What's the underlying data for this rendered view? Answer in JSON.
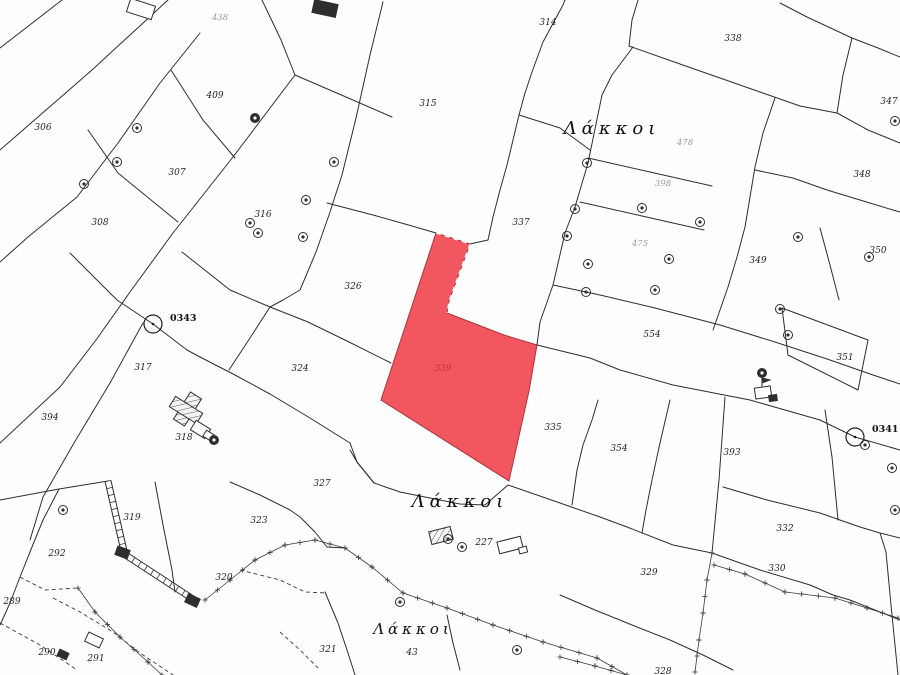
{
  "map": {
    "region_name": "Λάκκοι",
    "place_labels": [
      {
        "text": "Λάκκοι",
        "x": 612,
        "y": 134,
        "size": 18,
        "spacing": 5
      },
      {
        "text": "Λάκκοι",
        "x": 460,
        "y": 507,
        "size": 18,
        "spacing": 5
      },
      {
        "text": "Λάκκοι",
        "x": 413,
        "y": 634,
        "size": 15,
        "spacing": 4
      }
    ],
    "parcel_labels": [
      {
        "text": "306",
        "x": 43,
        "y": 130
      },
      {
        "text": "409",
        "x": 215,
        "y": 98
      },
      {
        "text": "307",
        "x": 177,
        "y": 175
      },
      {
        "text": "308",
        "x": 100,
        "y": 225
      },
      {
        "text": "316",
        "x": 263,
        "y": 217
      },
      {
        "text": "315",
        "x": 428,
        "y": 106
      },
      {
        "text": "314",
        "x": 548,
        "y": 25
      },
      {
        "text": "338",
        "x": 733,
        "y": 41
      },
      {
        "text": "347",
        "x": 889,
        "y": 104
      },
      {
        "text": "348",
        "x": 862,
        "y": 177
      },
      {
        "text": "349",
        "x": 758,
        "y": 263
      },
      {
        "text": "350",
        "x": 878,
        "y": 253
      },
      {
        "text": "351",
        "x": 845,
        "y": 360
      },
      {
        "text": "337",
        "x": 521,
        "y": 225
      },
      {
        "text": "554",
        "x": 652,
        "y": 337
      },
      {
        "text": "317",
        "x": 143,
        "y": 370
      },
      {
        "text": "394",
        "x": 50,
        "y": 420
      },
      {
        "text": "318",
        "x": 184,
        "y": 440
      },
      {
        "text": "324",
        "x": 300,
        "y": 371
      },
      {
        "text": "326",
        "x": 353,
        "y": 289
      },
      {
        "text": "335",
        "x": 553,
        "y": 430
      },
      {
        "text": "354",
        "x": 619,
        "y": 451
      },
      {
        "text": "393",
        "x": 732,
        "y": 455
      },
      {
        "text": "292",
        "x": 57,
        "y": 556
      },
      {
        "text": "289",
        "x": 12,
        "y": 604
      },
      {
        "text": "319",
        "x": 132,
        "y": 520
      },
      {
        "text": "323",
        "x": 259,
        "y": 523
      },
      {
        "text": "320",
        "x": 224,
        "y": 580
      },
      {
        "text": "290",
        "x": 47,
        "y": 655
      },
      {
        "text": "291",
        "x": 96,
        "y": 661
      },
      {
        "text": "327",
        "x": 322,
        "y": 486
      },
      {
        "text": "227",
        "x": 484,
        "y": 545
      },
      {
        "text": "321",
        "x": 328,
        "y": 652
      },
      {
        "text": "43",
        "x": 412,
        "y": 655
      },
      {
        "text": "328",
        "x": 663,
        "y": 674
      },
      {
        "text": "329",
        "x": 649,
        "y": 575
      },
      {
        "text": "330",
        "x": 777,
        "y": 571
      },
      {
        "text": "332",
        "x": 785,
        "y": 531
      }
    ],
    "faint_labels": [
      {
        "text": "438",
        "x": 220,
        "y": 20
      },
      {
        "text": "478",
        "x": 685,
        "y": 145
      },
      {
        "text": "398",
        "x": 663,
        "y": 186
      },
      {
        "text": "475",
        "x": 640,
        "y": 246
      }
    ],
    "highlight_parcel": {
      "number": "339",
      "x": 443,
      "y": 371,
      "fill": "#f2565e",
      "points": "436,233 470,244 449,301 447,313 504,335 537,345 529,391 509,481 381,400"
    },
    "benchmarks": [
      {
        "label": "0343",
        "cx": 153,
        "cy": 324,
        "lx": 170,
        "ly": 321
      },
      {
        "label": "0341",
        "cx": 855,
        "cy": 437,
        "lx": 872,
        "ly": 432
      }
    ],
    "poles": [
      {
        "x": 137,
        "y": 128
      },
      {
        "x": 117,
        "y": 162
      },
      {
        "x": 84,
        "y": 184
      },
      {
        "x": 255,
        "y": 118,
        "filled": true
      },
      {
        "x": 306,
        "y": 200
      },
      {
        "x": 250,
        "y": 223
      },
      {
        "x": 258,
        "y": 233
      },
      {
        "x": 303,
        "y": 237
      },
      {
        "x": 334,
        "y": 162
      },
      {
        "x": 575,
        "y": 209
      },
      {
        "x": 567,
        "y": 236
      },
      {
        "x": 588,
        "y": 264
      },
      {
        "x": 642,
        "y": 208
      },
      {
        "x": 669,
        "y": 259
      },
      {
        "x": 655,
        "y": 290
      },
      {
        "x": 587,
        "y": 163
      },
      {
        "x": 700,
        "y": 222
      },
      {
        "x": 586,
        "y": 292
      },
      {
        "x": 798,
        "y": 237
      },
      {
        "x": 895,
        "y": 121
      },
      {
        "x": 869,
        "y": 257
      },
      {
        "x": 780,
        "y": 309
      },
      {
        "x": 788,
        "y": 335
      },
      {
        "x": 762,
        "y": 373,
        "filled": true
      },
      {
        "x": 865,
        "y": 445
      },
      {
        "x": 892,
        "y": 468
      },
      {
        "x": 895,
        "y": 510
      },
      {
        "x": 400,
        "y": 602
      },
      {
        "x": 517,
        "y": 650
      },
      {
        "x": 448,
        "y": 539
      },
      {
        "x": 462,
        "y": 547
      },
      {
        "x": 63,
        "y": 510
      },
      {
        "x": 214,
        "y": 440,
        "filled": true
      }
    ],
    "buildings": [
      {
        "x": 128,
        "y": 2,
        "w": 26,
        "h": 14,
        "r": 18,
        "s": "outline"
      },
      {
        "x": 313,
        "y": 2,
        "w": 24,
        "h": 13,
        "r": 12,
        "s": "solid"
      },
      {
        "x": 181,
        "y": 393,
        "w": 13,
        "h": 32,
        "r": 32,
        "s": "hatch"
      },
      {
        "x": 170,
        "y": 404,
        "w": 32,
        "h": 12,
        "r": 32,
        "s": "hatch"
      },
      {
        "x": 192,
        "y": 424,
        "w": 17,
        "h": 11,
        "r": 32,
        "s": "outline"
      },
      {
        "x": 204,
        "y": 432,
        "w": 9,
        "h": 7,
        "r": 32,
        "s": "outline"
      },
      {
        "x": 430,
        "y": 529,
        "w": 22,
        "h": 13,
        "r": -14,
        "s": "hatch"
      },
      {
        "x": 498,
        "y": 539,
        "w": 24,
        "h": 12,
        "r": -14,
        "s": "outline"
      },
      {
        "x": 519,
        "y": 547,
        "w": 8,
        "h": 6,
        "r": -14,
        "s": "outline"
      },
      {
        "x": 116,
        "y": 548,
        "w": 13,
        "h": 9,
        "r": 20,
        "s": "solid"
      },
      {
        "x": 186,
        "y": 596,
        "w": 13,
        "h": 9,
        "r": 25,
        "s": "solid"
      },
      {
        "x": 86,
        "y": 635,
        "w": 16,
        "h": 10,
        "r": 25,
        "s": "outline"
      },
      {
        "x": 58,
        "y": 651,
        "w": 10,
        "h": 7,
        "r": 25,
        "s": "solid"
      },
      {
        "x": 755,
        "y": 387,
        "w": 16,
        "h": 11,
        "r": -8,
        "s": "outline"
      },
      {
        "x": 769,
        "y": 395,
        "w": 8,
        "h": 6,
        "r": -8,
        "s": "solid"
      }
    ],
    "colors": {
      "boundary": "#2e2e2e",
      "highlight": "#f2565e",
      "highlight_number": "#c23441",
      "paper": "#fefefe"
    }
  }
}
